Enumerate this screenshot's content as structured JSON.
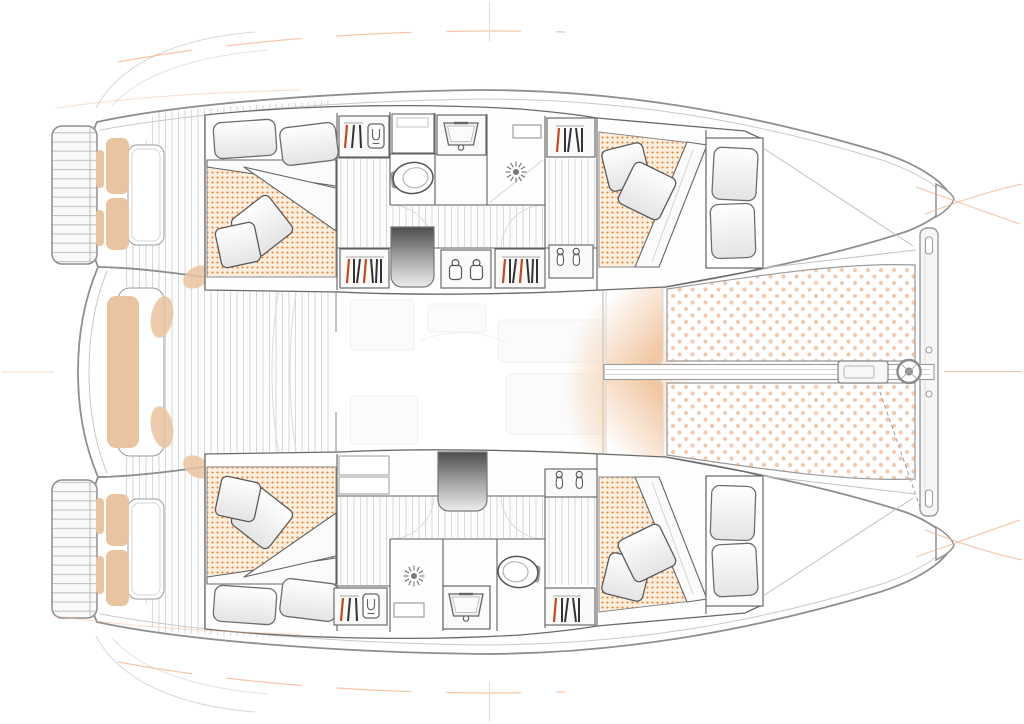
{
  "image": {
    "kind": "catamaran interior layout plan",
    "view": "top-down deck plan, bow to the right",
    "background": "#ffffff"
  },
  "palette": {
    "hull_outline": "#8f8f8f",
    "wall_line": "#5f5f5f",
    "deck_plank_line": "#d8d8d8",
    "mattress_bg": "#fdeedd",
    "mattress_dot": "#e57e30",
    "trampoline_dot": "#f3c9ae",
    "cushion_tan": "#eac3a0",
    "pad_peach": "#f1c7a4",
    "accent_orange": "#f0b28c",
    "hanger_red": "#bf4a22",
    "steps_dark": "#4d4d4d",
    "steps_light": "#ededed",
    "glow_peach": "#f2c9a2"
  },
  "areas": {
    "cockpit": {
      "label": "Aft cockpit with twin transom steps, helm seats and centre bench"
    },
    "salon": {
      "label": "Bridgedeck salon (shown faded) with companionway steps down to each hull"
    },
    "port_hull": {
      "label": "Port hull: aft double cabin, wardrobes, head with washbasin, shower and toilet, forward double cabin"
    },
    "starboard_hull": {
      "label": "Starboard hull: aft double cabin, wardrobes, head with washbasin, shower and toilet, forward double cabin"
    },
    "foredeck": {
      "label": "Foredeck with sun pads, twin bow trampolines, bowsprit and forward crossbeam"
    }
  },
  "counts": {
    "double_berths": 4,
    "pillows": 8,
    "throw_cushions": 8,
    "toilets": 2,
    "washbasins": 2,
    "showers": 2,
    "wardrobes": 6,
    "footwear_lockers": 2,
    "companionway_steps": 2
  }
}
